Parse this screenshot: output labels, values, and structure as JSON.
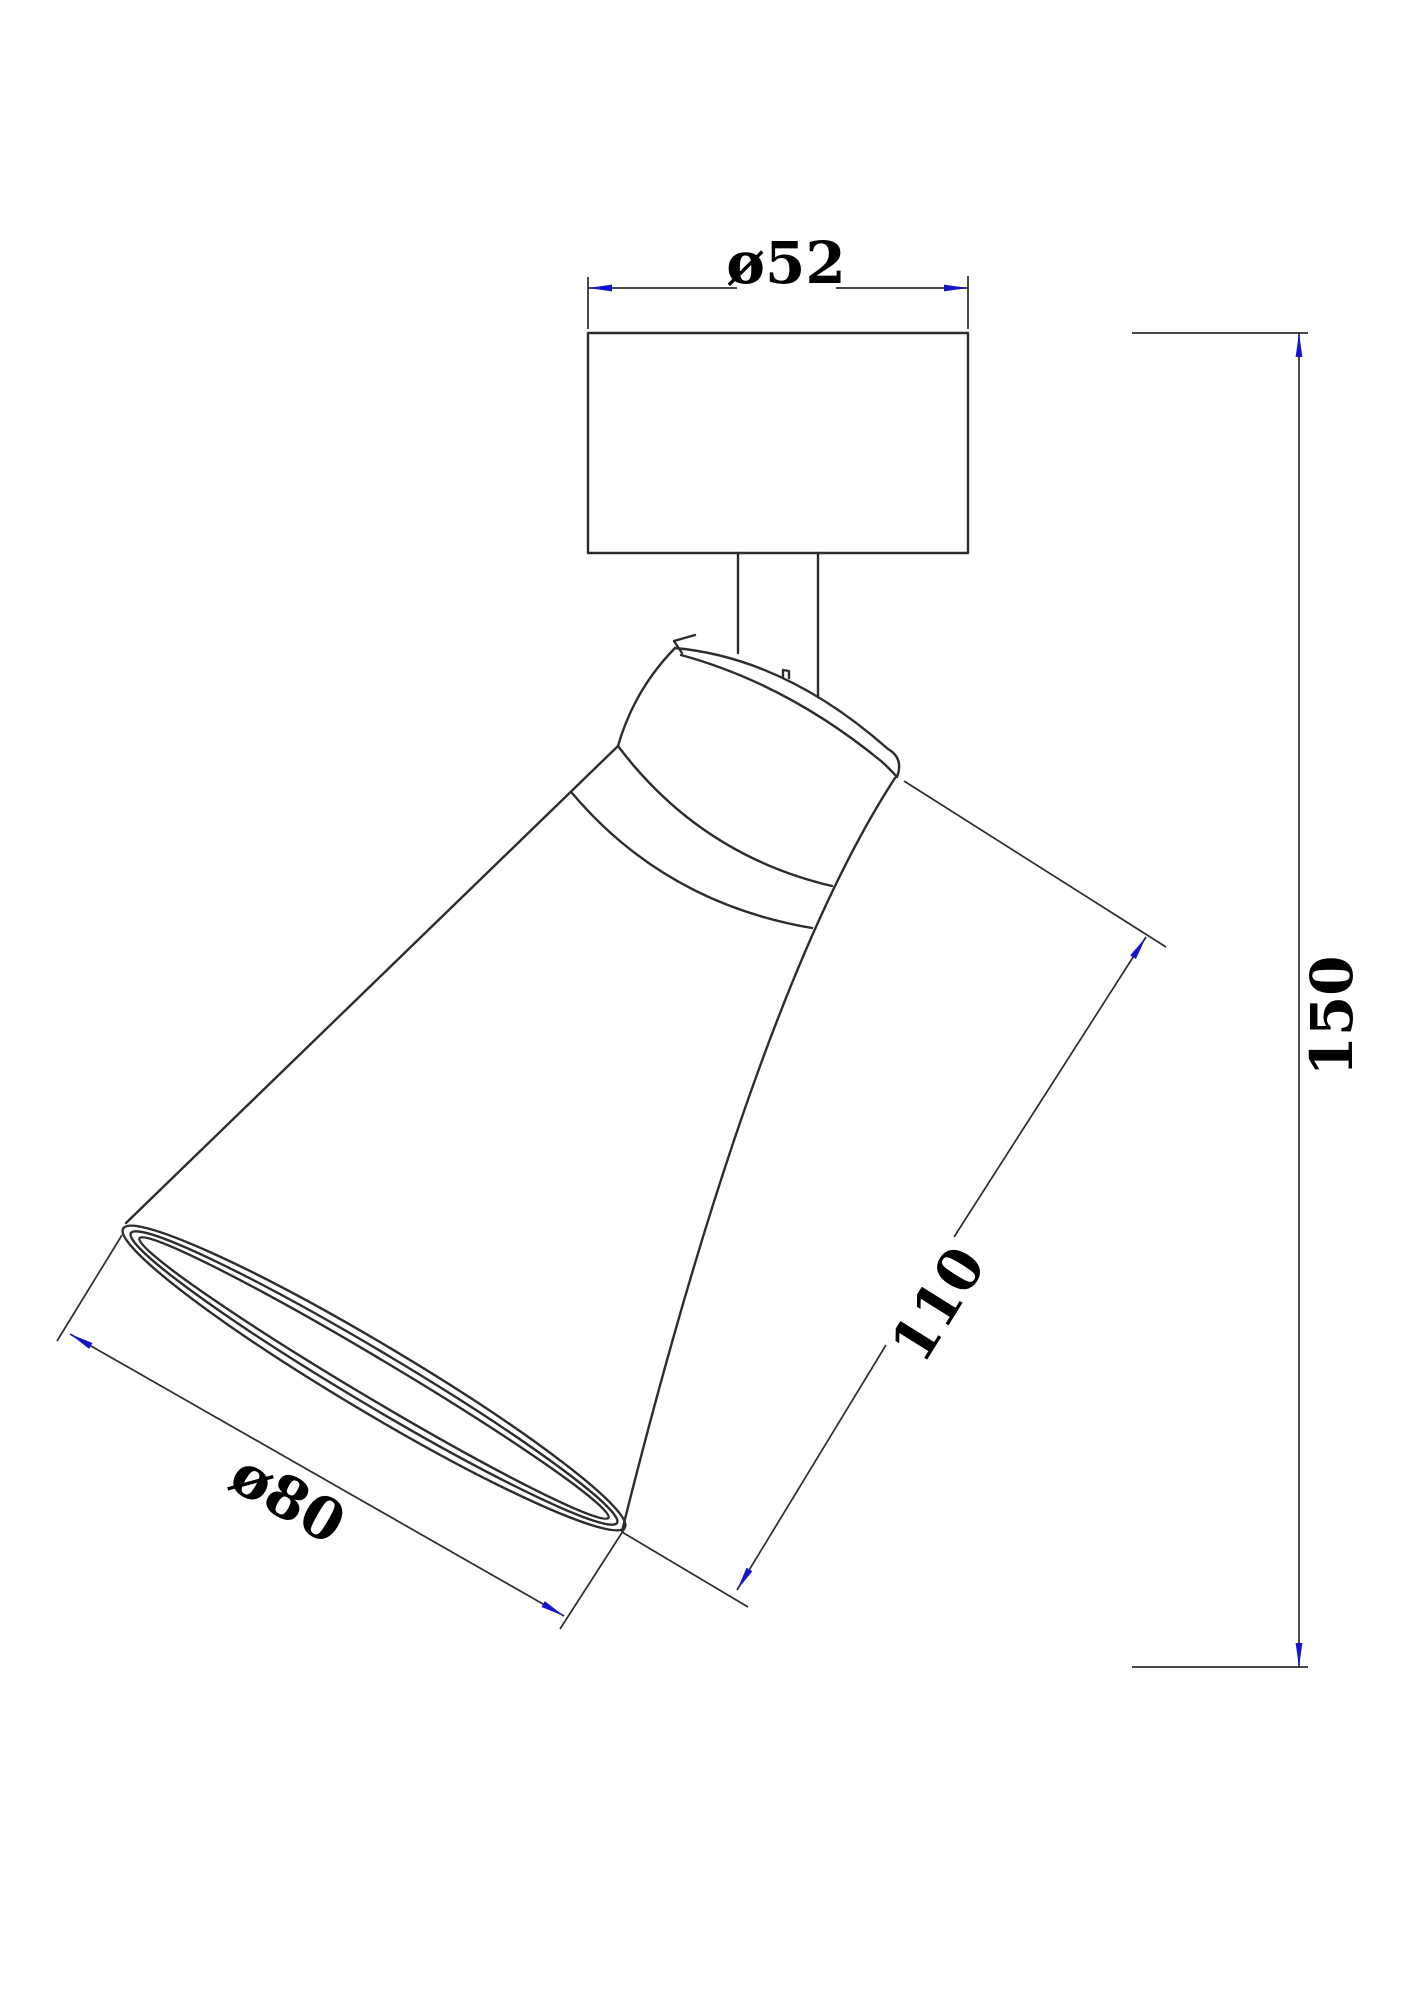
{
  "drawing": {
    "type": "technical-drawing",
    "description": "Dimensioned line drawing of an adjustable spot lamp: cylindrical ceiling mount with stem and tilted conical shade",
    "colors": {
      "line": "#2d2d2d",
      "arrow": "#1414c8",
      "text": "#000000",
      "background": "#ffffff"
    },
    "dimensions": {
      "mount_diameter": {
        "label": "ø52",
        "value": 52,
        "kind": "diameter"
      },
      "overall_height": {
        "label": "150",
        "value": 150,
        "kind": "linear"
      },
      "head_length": {
        "label": "110",
        "value": 110,
        "kind": "linear"
      },
      "shade_diameter": {
        "label": "ø80",
        "value": 80,
        "kind": "diameter"
      }
    }
  }
}
